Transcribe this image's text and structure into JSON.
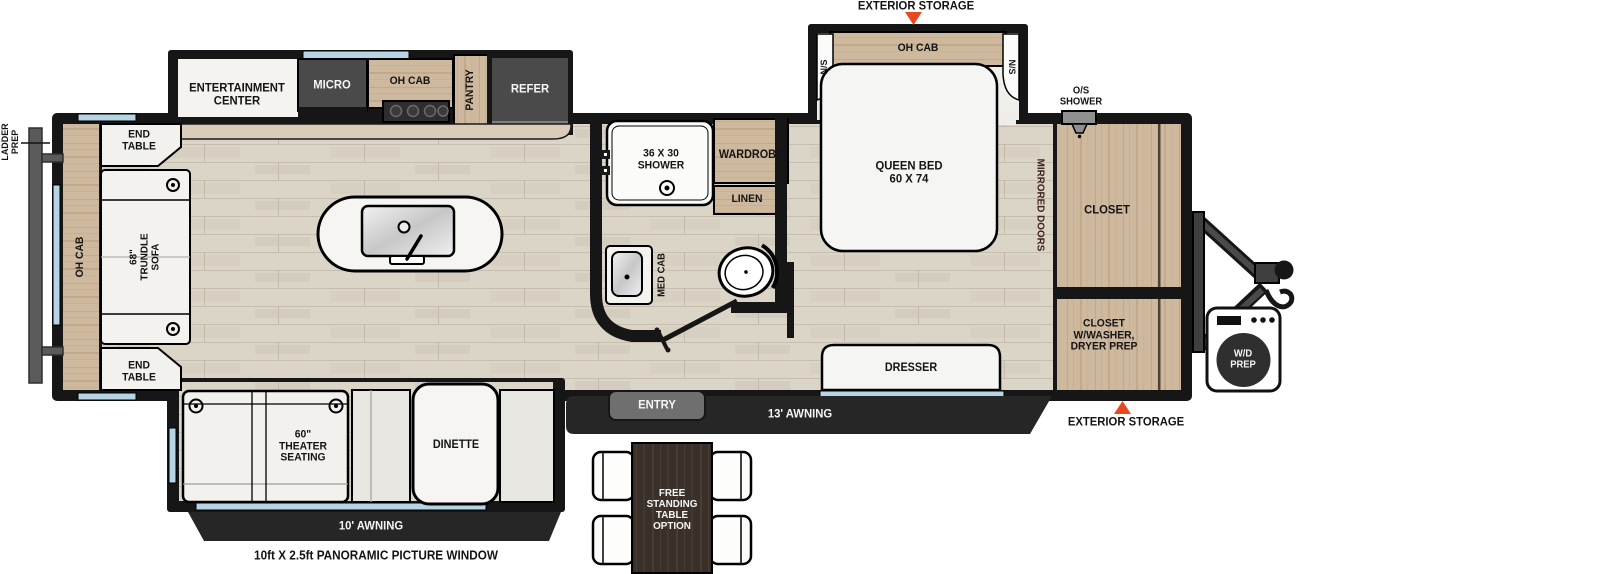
{
  "floorplan": {
    "type": "travel-trailer-floorplan",
    "colors": {
      "accent_red": "#e8491d",
      "cabinet_wood": "#cfb99e",
      "dark_bar": "#262626",
      "window_blue": "#b7d4e4",
      "appliance_gray": "#4a4a4a",
      "wall_black": "#161616"
    },
    "exterior": {
      "storage_top_label": "EXTERIOR STORAGE",
      "storage_front_label": "EXTERIOR STORAGE",
      "ladder_label": "LADDER\nPREP",
      "entry_label": "ENTRY",
      "awning_door_label": "13' AWNING",
      "awning_slide_label": "10' AWNING",
      "picture_window_label": "10ft X 2.5ft PANORAMIC PICTURE WINDOW",
      "os_shower_label": "O/S\nSHOWER",
      "wd_prep_label": "W/D\nPREP"
    },
    "living": {
      "oh_cab_rear": "OH CAB",
      "end_table_top": "END\nTABLE",
      "end_table_bottom": "END\nTABLE",
      "sofa_label": "68\"\nTRUNDLE\nSOFA",
      "theater_label": "60\"\nTHEATER\nSEATING",
      "dinette_label": "DINETTE",
      "table_option_label": "FREE\nSTANDING\nTABLE\nOPTION"
    },
    "kitchen": {
      "entertainment_label": "ENTERTAINMENT\nCENTER",
      "micro_label": "MICRO",
      "oh_cab_label": "OH CAB",
      "pantry_label": "PANTRY",
      "refer_label": "REFER"
    },
    "bathroom": {
      "shower_label": "36 X 30\nSHOWER",
      "wardrobe_label": "WARDROBE",
      "linen_label": "LINEN",
      "med_cab_label": "MED CAB"
    },
    "bedroom": {
      "ns_left_label": "N/S",
      "ns_right_label": "N/S",
      "oh_cab_label": "OH CAB",
      "bed_label": "QUEEN BED\n60 X 74",
      "mirrored_doors_label": "MIRRORED DOORS",
      "dresser_label": "DRESSER",
      "closet_label": "CLOSET",
      "closet_washer_label": "CLOSET\nW/WASHER,\nDRYER PREP"
    }
  }
}
